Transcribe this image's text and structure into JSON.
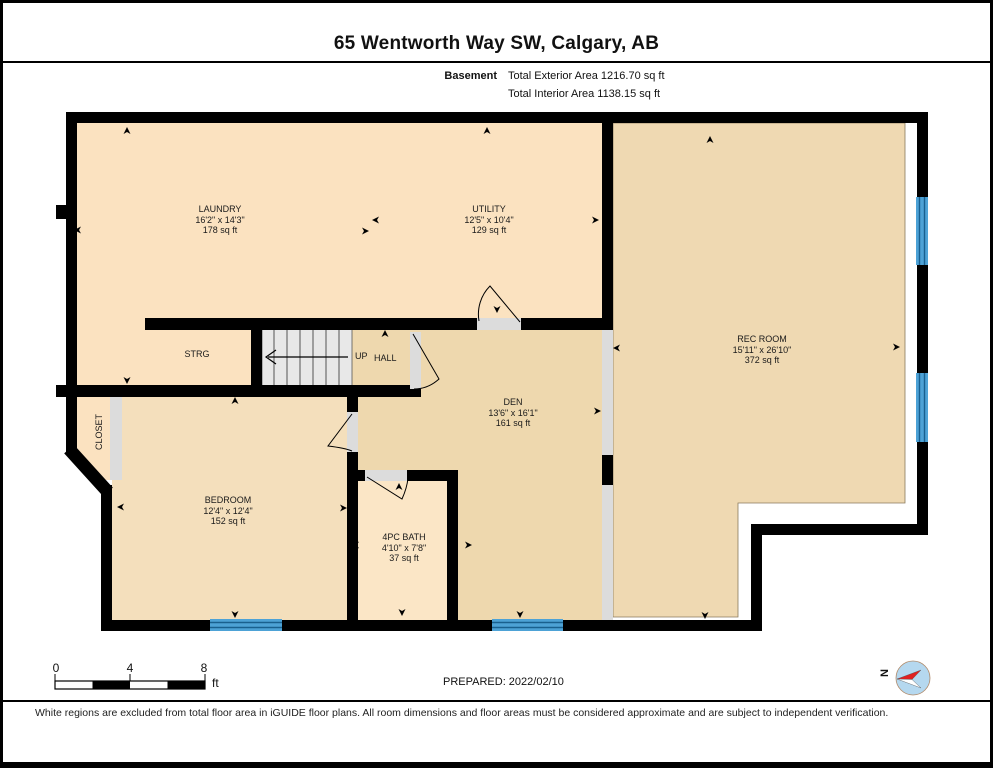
{
  "header": {
    "title": "65 Wentworth Way SW, Calgary, AB",
    "floor_label": "Basement",
    "total_exterior": "Total Exterior Area 1216.70 sq ft",
    "total_interior": "Total Interior Area 1138.15 sq ft"
  },
  "rooms": [
    {
      "name": "LAUNDRY",
      "dims": "16'2\" x 14'3\"",
      "area": "178 sq ft"
    },
    {
      "name": "UTILITY",
      "dims": "12'5\" x 10'4\"",
      "area": "129 sq ft"
    },
    {
      "name": "REC ROOM",
      "dims": "15'11\" x 26'10\"",
      "area": "372 sq ft"
    },
    {
      "name": "DEN",
      "dims": "13'6\" x 16'1\"",
      "area": "161 sq ft"
    },
    {
      "name": "BEDROOM",
      "dims": "12'4\" x 12'4\"",
      "area": "152 sq ft"
    },
    {
      "name": "4PC BATH",
      "dims": "4'10\" x 7'8\"",
      "area": "37 sq ft"
    },
    {
      "name": "STRG"
    },
    {
      "name": "CLOSET"
    },
    {
      "name": "HALL"
    },
    {
      "name": "UP"
    }
  ],
  "scale_bar": {
    "ticks": [
      "0",
      "4",
      "8"
    ],
    "unit": "ft"
  },
  "compass": {
    "label": "N"
  },
  "footer": {
    "prepared": "PREPARED: 2022/02/10",
    "disclaimer": "White regions are excluded from total floor area in iGUIDE floor plans. All room dimensions and floor areas must be considered approximate and are subject to independent verification."
  },
  "icons": {
    "compass": "compass-needle-icon",
    "stairs_direction": "left-arrow-icon",
    "measurement_marker": "dart-arrow-icon"
  },
  "colors": {
    "wall": "#000000",
    "floor_light": "#fbe2c0",
    "floor_bedroom": "#f4dfbc",
    "floor_dark": "#eed8ae",
    "floor_bath": "#fbe6c6",
    "window": "#4da2d6",
    "stairs": "#e8e8e8",
    "opening": "#dcdcdc",
    "compass_fill": "#b5d8ef",
    "compass_needle": "#e02020"
  }
}
